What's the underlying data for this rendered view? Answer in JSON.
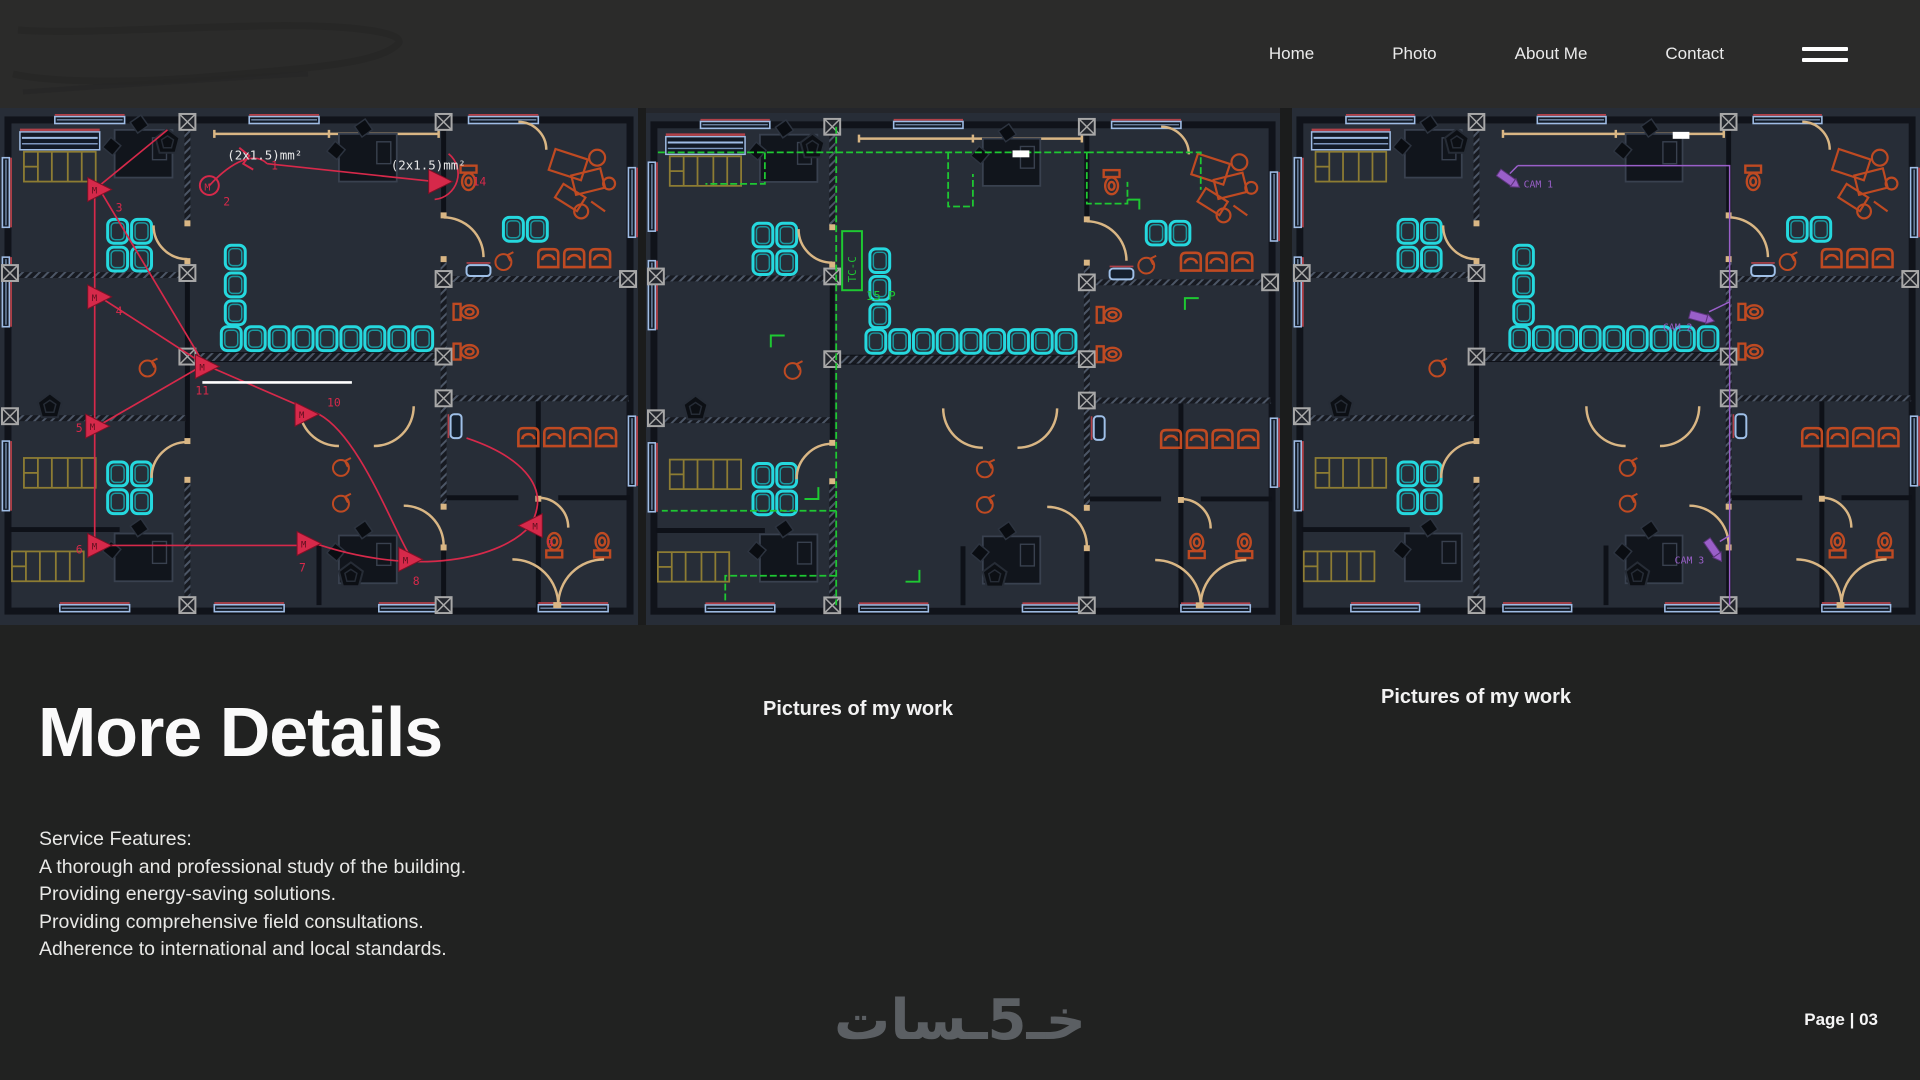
{
  "nav": {
    "items": [
      {
        "label": "Home"
      },
      {
        "label": "Photo"
      },
      {
        "label": "About Me"
      },
      {
        "label": "Contact"
      }
    ]
  },
  "plans": {
    "caption_left": "Pictures of my work",
    "caption_right": "Pictures of my work",
    "p1": {
      "spec1": "(2x1.5)mm²",
      "spec2": "(2x1.5)mm²",
      "nums": [
        "1",
        "2",
        "3",
        "4",
        "5",
        "6",
        "7",
        "8",
        "9",
        "10",
        "11",
        "14"
      ],
      "motor_letter": "M"
    },
    "p2": {
      "panel_label": "TC-C",
      "breaker_label": "15 P"
    },
    "p3": {
      "cam1": "CAM 1",
      "cam2": "CAM 2",
      "cam3": "CAM 3"
    }
  },
  "details": {
    "heading": "More Details",
    "features": [
      "Service Features:",
      "A thorough and professional study of the building.",
      "Providing energy-saving solutions.",
      "Providing comprehensive field consultations.",
      "Adherence to international and local standards."
    ]
  },
  "footer": {
    "watermark": "خـ5ـسات",
    "page_label": "Page | 03"
  },
  "colors": {
    "background": "#212221",
    "header": "#2b2b2a",
    "plan_background": "#272d37",
    "wall": "#10131a",
    "tan": "#d9b684",
    "cyan": "#25d8de",
    "orange": "#bf4a22",
    "red_wiring": "#d6294a",
    "green_wiring": "#1ec832",
    "purple_cctv": "#9a5fc9",
    "window_blue": "#9fbce4"
  }
}
